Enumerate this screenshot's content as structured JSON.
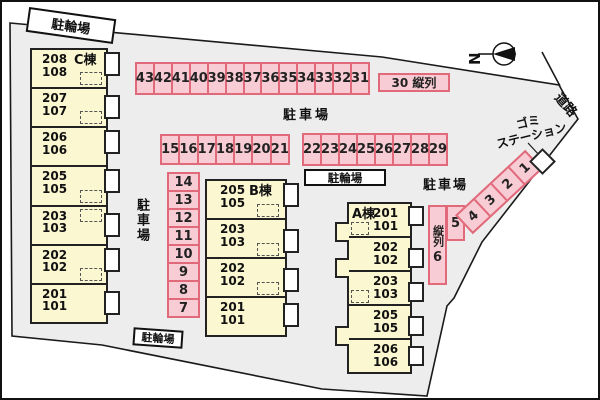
{
  "colors": {
    "space_fill": "#f8ccd5",
    "space_border": "#e0697a",
    "building_fill": "#fbf7d0",
    "site_fill": "#ededed",
    "outline": "#1a1a1a"
  },
  "compass": {
    "north_label": "N"
  },
  "labels": {
    "road": "道路",
    "garbage_line1": "ゴミ",
    "garbage_line2": "ステーション",
    "bicycle_top": "駐輪場",
    "bicycle_center": "駐輪場",
    "bicycle_bottom": "駐輪場",
    "parking_center": "駐車場",
    "parking_west": "駐車場",
    "parking_east": "駐車場",
    "tandem_30": "30 縦列",
    "tandem_vertical": "縦列",
    "space_5": "5",
    "space_6": "6"
  },
  "parking": {
    "top_row": [
      "43",
      "42",
      "41",
      "40",
      "39",
      "38",
      "37",
      "36",
      "35",
      "34",
      "33",
      "32",
      "31"
    ],
    "row_15_21": [
      "15",
      "16",
      "17",
      "18",
      "19",
      "20",
      "21"
    ],
    "row_22_29": [
      "22",
      "23",
      "24",
      "25",
      "26",
      "27",
      "28",
      "29"
    ],
    "column_7_14": [
      "14",
      "13",
      "12",
      "11",
      "10",
      "9",
      "8",
      "7"
    ],
    "diagonal_1_4": [
      "4",
      "3",
      "2",
      "1"
    ]
  },
  "buildings": {
    "a": {
      "name": "A棟",
      "rooms": [
        {
          "u": "201",
          "l": "101"
        },
        {
          "u": "202",
          "l": "102"
        },
        {
          "u": "203",
          "l": "103"
        },
        {
          "u": "205",
          "l": "105"
        },
        {
          "u": "206",
          "l": "106"
        }
      ]
    },
    "b": {
      "name": "B棟",
      "rooms": [
        {
          "u": "205",
          "l": "105"
        },
        {
          "u": "203",
          "l": "103"
        },
        {
          "u": "202",
          "l": "102"
        },
        {
          "u": "201",
          "l": "101"
        }
      ]
    },
    "c": {
      "name": "C棟",
      "rooms": [
        {
          "u": "208",
          "l": "108"
        },
        {
          "u": "207",
          "l": "107"
        },
        {
          "u": "206",
          "l": "106"
        },
        {
          "u": "205",
          "l": "105"
        },
        {
          "u": "203",
          "l": "103"
        },
        {
          "u": "202",
          "l": "102"
        },
        {
          "u": "201",
          "l": "101"
        }
      ]
    }
  }
}
